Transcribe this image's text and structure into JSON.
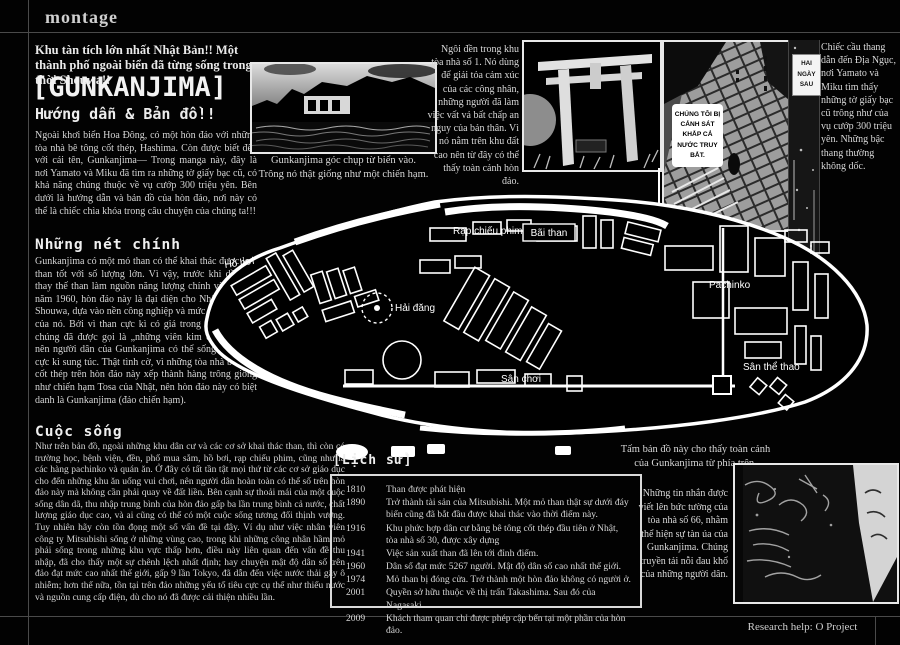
{
  "page": {
    "brand": "montage",
    "footer": "Research help: O Project"
  },
  "intro": {
    "headline": "Khu tàn tích lớn nhất Nhật Bản!! Một thành phố ngoài biển đã từng sống trong thời Shouwa!!",
    "title": "[GUNKANJIMA]",
    "subtitle": "Hướng dẫn & Bản đồ!!",
    "lead": "Ngoài khơi biển Hoa Đông, có một hòn đảo với những tòa nhà bê tông cốt thép, Hashima. Còn được biết đến với cái tên, Gunkanjima— Trong manga này, đây là nơi Yamato và Miku đã tìm ra những tờ giấy bạc cũ, có khả năng chúng thuộc về vụ cướp 300 triệu yên. Bên dưới là hướng dẫn và bản đồ của hòn đảo, nơi này có thể là chiếc chìa khóa trong câu chuyện của chúng ta!!!"
  },
  "sections": [
    {
      "heading": "Những nét chính",
      "body": "Gunkanjima có một mỏ than có thể khai thác được loại than tốt với số lượng lớn. Vì vậy, trước khi dầu mỏ thay thế than làm nguồn năng lượng chính vào những năm 1960, hòn đảo này là đại diện cho Nhật Bản thời Shouwa, dựa vào nền công nghiệp và mức hiện đại hóa của nó. Bởi vì than cực kì có giá trong thời đại này, chúng đã được gọi là „những viên kim cương đen”, nên người dân của Gunkanjima có thể sống một cách cực kì sung túc. Thật tình cờ, vì những tòa nhà bê tông cốt thép trên hòn đảo này xếp thành hàng trông giống như chiến hạm Tosa của Nhật, nên hòn đảo này có biệt danh là Gunkanjima (đảo chiến hạm)."
    },
    {
      "heading": "Cuộc sống",
      "body": "Như trên bản đồ, ngoài những khu dân cư và các cơ sở khai thác than, thì còn có trường học, bệnh viện, đền, phố mua sắm, hồ bơi, rạp chiếu phim, cũng như là các hàng pachinko và quán ăn. Ở đây có tất tần tật mọi thứ từ các cơ sở giáo dục cho đến những khu ăn uống vui chơi, nên người dân hoàn toàn có thể số trên hòn đảo này mà không cần phải quay về đất liền. Bên cạnh sự thoải mái của một cuộc sống dân dã, thu nhập trung bình của hòn đảo gấp ba lần trung bình cả nước, chất lượng giáo dục cao, và ai cũng có thể có một cuộc sống tương đối thịnh vượng. Tuy nhiên hãy còn tồn đọng một số vấn đề tại đây. Ví dụ như việc nhân viên công ty Mitsubishi sống ở những vùng cao, trong khi những công nhân hầm mỏ phải sống trong những khu vực thấp hơn, điều này liên quan đến vấn đề thu nhập, đã cho thấy một sự chênh lệch nhất định; hay chuyện mật độ dân số trên đảo đạt mức cao nhất thế giới, gấp 9 lần Tokyo, đã dẫn đến việc nước thải gây ô nhiễm; hơn thế nữa, tồn tại trên đảo những yếu tố tiêu cực cụ thể như thiếu nước và nguồn cung cấp điện, dù cho nó đã được cải thiện nhiều lần."
    }
  ],
  "photos": {
    "sea_view_caption": "Gunkanjima góc chụp từ biển vào.\nTrông nó thật giống như một chiến hạm.",
    "shrine_note": "Ngôi đền trong khu tòa nhà số 1. Nó dùng để giải tỏa cảm xúc của các công nhân, những người đã làm việc vất vả bất chấp an nguy của bản thân. Vì nó nằm trên khu đất cao nên từ đây có thể thấy toàn cảnh hòn đảo.",
    "stairs_note": "Chiếc cầu thang dẫn đến Địa Ngục, nơi Yamato và Miku tìm thấy những tờ giấy bạc cũ trông như của vụ cướp 300 triệu yên. Những bậc thang thường không dốc.",
    "stairs_bubble": "CHÚNG TÔI BỊ CẢNH SÁT KHẮP CẢ NƯỚC TRUY BẮT.",
    "time_label": "HAI NGÀY SAU",
    "walls_note": "Những tin nhắn được viết lên bức tường của tòa nhà số 66, nhằm thể hiện sự tàn úa của Gunkanjima. Chúng truyền tải nỗi đau khổ của những người dân."
  },
  "map": {
    "caption": "Tấm bản đồ này cho thấy toàn cảnh\ncủa Gunkanjima từ phía trên.",
    "labels": [
      "Rạp chiếu phim",
      "Bãi than",
      "Hồ bơi",
      "Hải đăng",
      "Sân chơi",
      "Pachinko",
      "Sân thể thao"
    ]
  },
  "history": {
    "heading": "[Lịch sử]",
    "events": [
      {
        "year": "1810",
        "text": "Than được phát hiện"
      },
      {
        "year": "1890",
        "text": "Trở thành tài sản của Mitsubishi. Một mỏ than thật sự dưới đáy biển cũng đã bắt đầu được khai thác vào thời điểm này."
      },
      {
        "year": "1916",
        "text": "Khu phức hợp dân cư bằng bê tông cốt thép đầu tiên ở Nhật, tòa nhà số 30, được xây dựng"
      },
      {
        "year": "1941",
        "text": "Việc sản xuất than đã lên tới đỉnh điểm."
      },
      {
        "year": "1960",
        "text": "Dân số đạt mức 5267 người. Mật độ dân số cao nhất thế giới."
      },
      {
        "year": "1974",
        "text": "Mỏ than bị đóng cửa. Trở thành một hòn đảo không có người ở."
      },
      {
        "year": "2001",
        "text": "Quyền sở hữu thuộc về thị trấn Takashima. Sau đó của Nagasaki."
      },
      {
        "year": "2009",
        "text": "Khách tham quan chỉ được phép cập bến tại một phần của hòn đảo."
      }
    ]
  }
}
